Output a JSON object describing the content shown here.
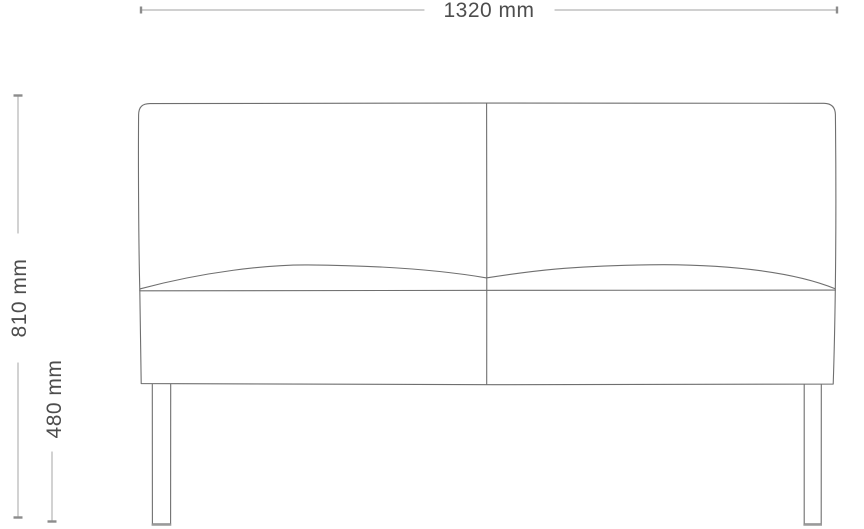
{
  "canvas": {
    "width": 864,
    "height": 529,
    "background": "#ffffff"
  },
  "dimensions": {
    "width": {
      "label": "1320 mm"
    },
    "overall_height": {
      "label": "810 mm"
    },
    "seat_height": {
      "label": "480 mm"
    }
  },
  "colors": {
    "sofa_outline": "#6f6f6f",
    "leg_foot": "#9a9a9a",
    "dimension_line": "#b5b5b5",
    "dimension_tick": "#8c8c8c",
    "label_text": "#4d4d4d",
    "background": "#ffffff"
  }
}
